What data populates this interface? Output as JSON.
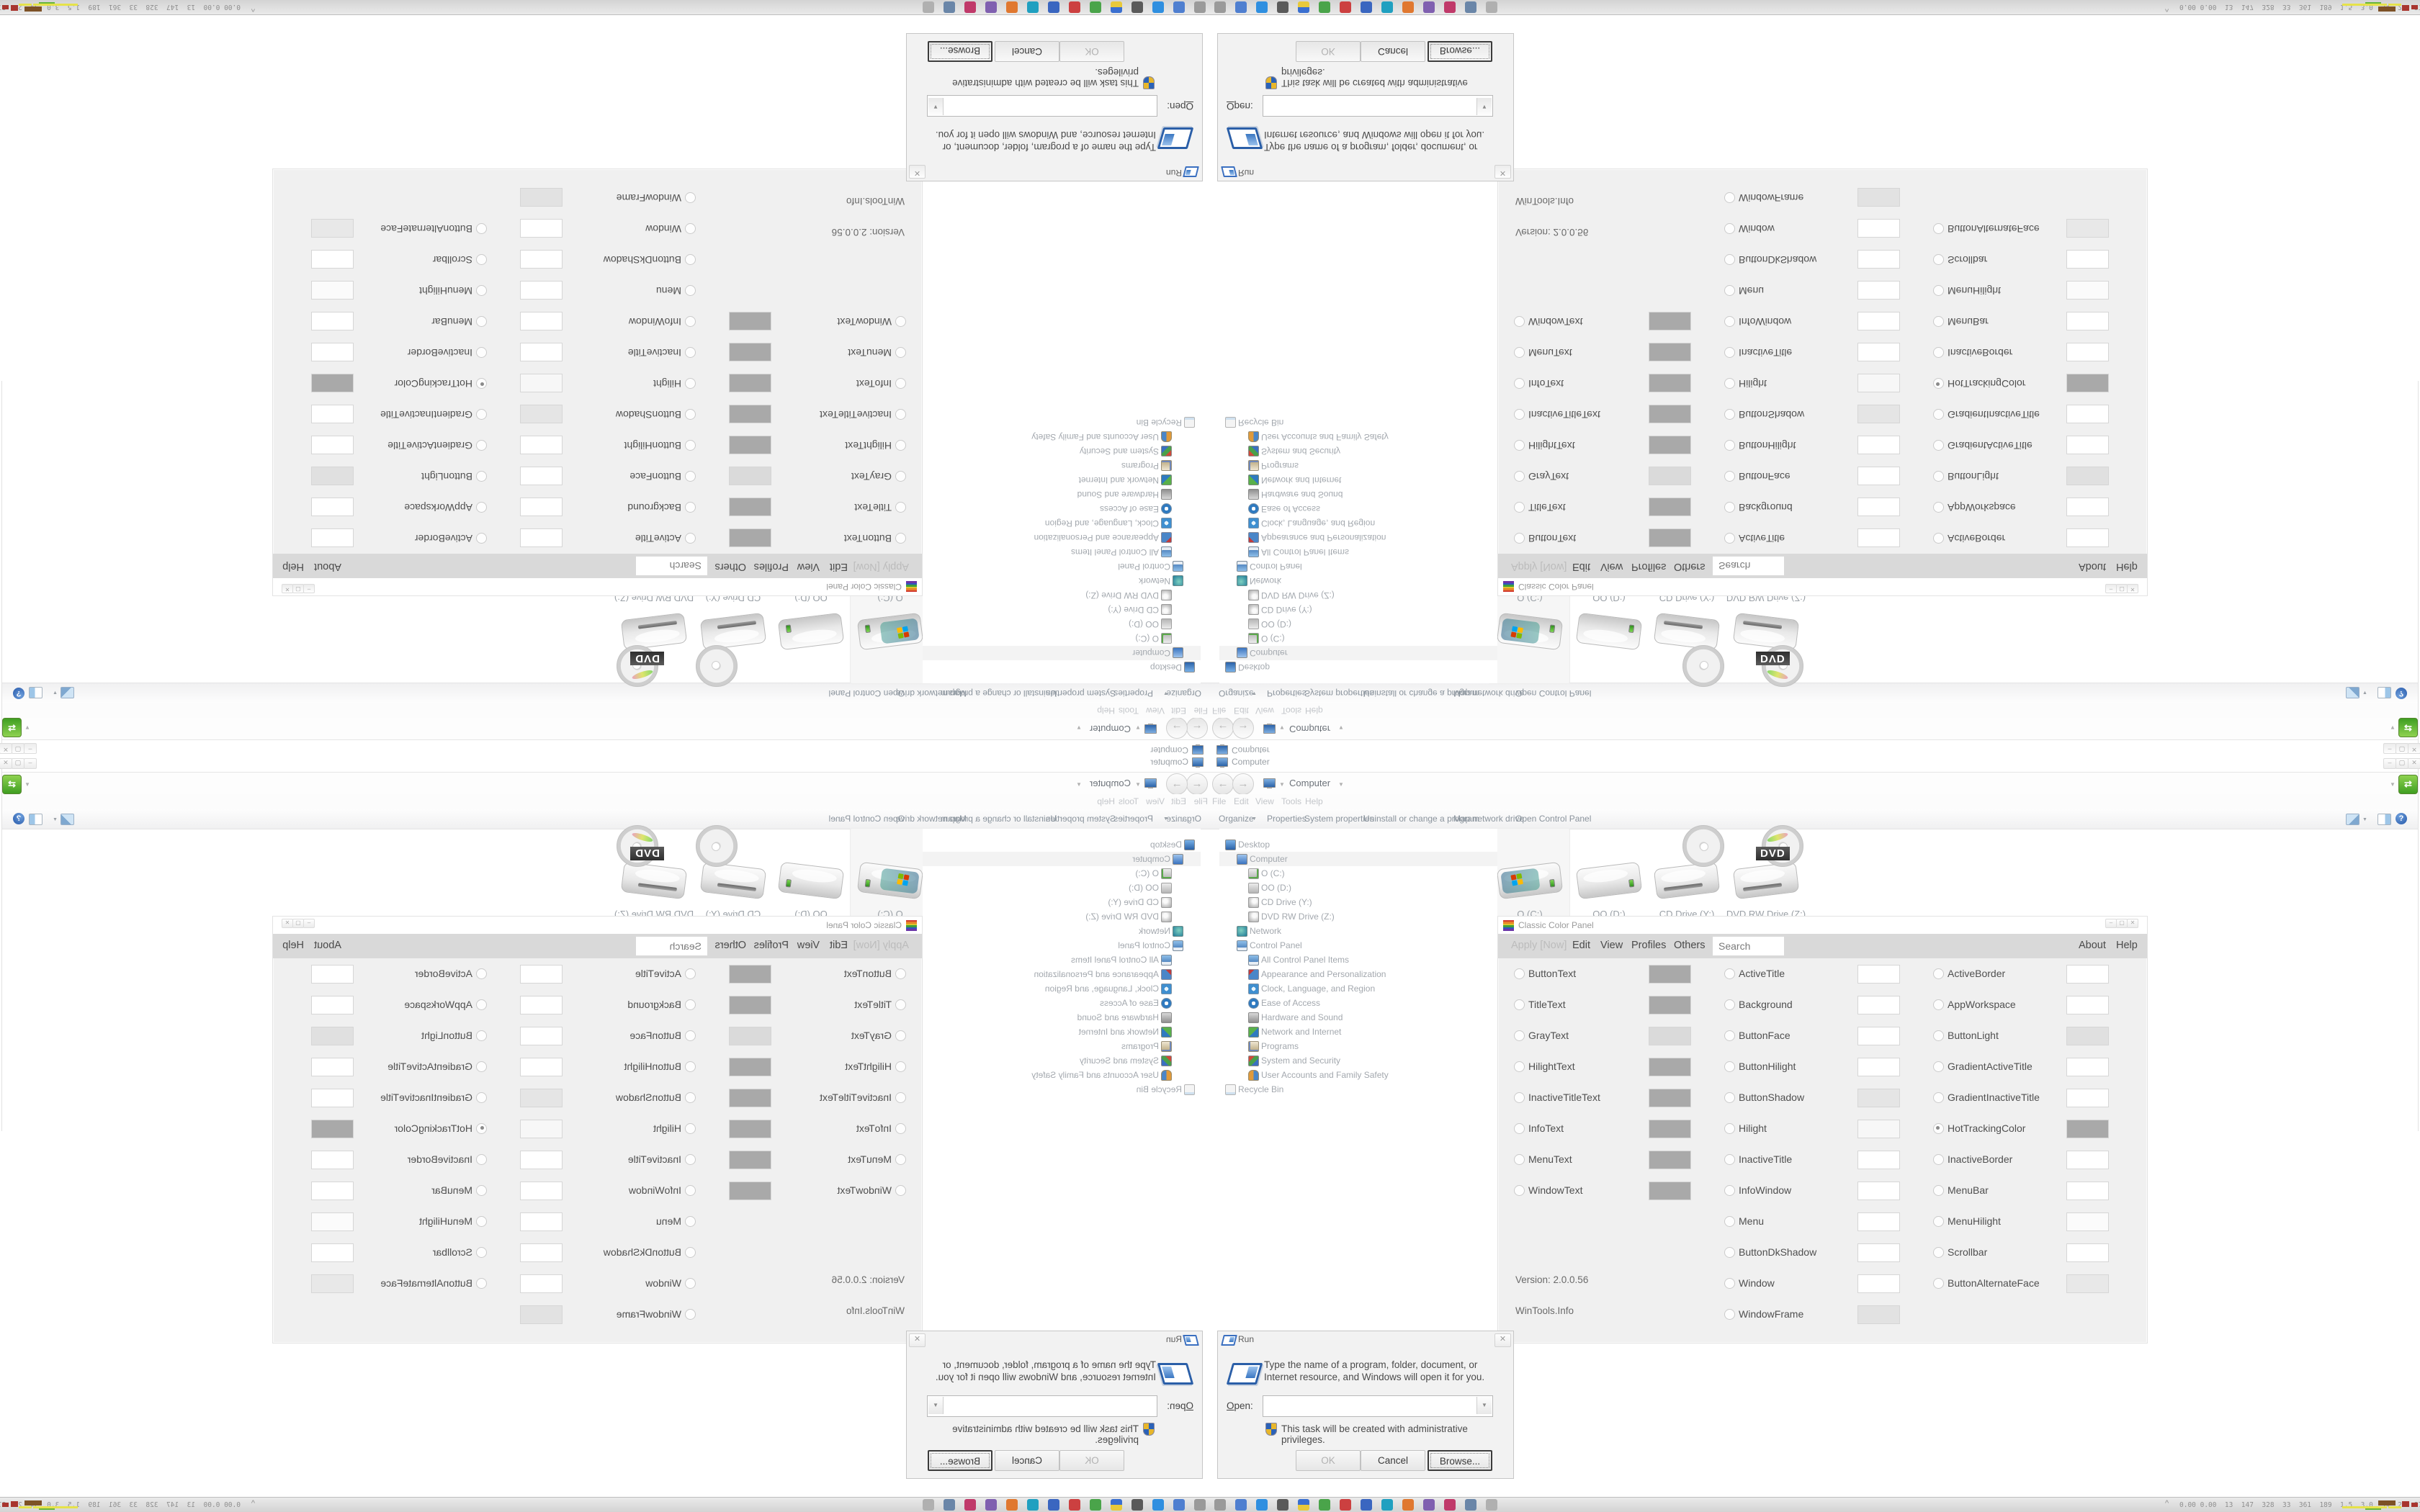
{
  "peek": {
    "computer_label": "Computer"
  },
  "explorer": {
    "menu_items": [
      "File",
      "Edit",
      "View",
      "Tools",
      "Help"
    ],
    "toolbar": {
      "organize_label": "Organize",
      "items": [
        "Properties",
        "System properties",
        "Uninstall or change a program",
        "Map network drive",
        "Open Control Panel"
      ]
    },
    "address": {
      "location": "Computer"
    },
    "dvd_tag": "DVD",
    "drives": [
      {
        "label": "O (C:)",
        "type": "system",
        "selected": true
      },
      {
        "label": "OO (D:)",
        "type": "hdd",
        "selected": false
      },
      {
        "label": "CD Drive (Y:)",
        "type": "cd",
        "selected": false
      },
      {
        "label": "DVD RW Drive (Z:)",
        "type": "dvd",
        "selected": false
      }
    ]
  },
  "tree": {
    "items": [
      {
        "label": "Desktop",
        "icon": "desktop",
        "indent": 0,
        "highlight": false
      },
      {
        "label": "Computer",
        "icon": "computer",
        "indent": 1,
        "highlight": true
      },
      {
        "label": "O (C:)",
        "icon": "system-drive",
        "indent": 2,
        "highlight": false
      },
      {
        "label": "OO (D:)",
        "icon": "hdd",
        "indent": 2,
        "highlight": false
      },
      {
        "label": "CD Drive (Y:)",
        "icon": "cd-drive",
        "indent": 2,
        "highlight": false
      },
      {
        "label": "DVD RW Drive (Z:)",
        "icon": "dvd-drive",
        "indent": 2,
        "highlight": false
      },
      {
        "label": "Network",
        "icon": "network",
        "indent": 1,
        "highlight": false
      },
      {
        "label": "Control Panel",
        "icon": "control-panel",
        "indent": 1,
        "highlight": false
      },
      {
        "label": "All Control Panel Items",
        "icon": "control-panel",
        "indent": 2,
        "highlight": false
      },
      {
        "label": "Appearance and Personalization",
        "icon": "appearance",
        "indent": 2,
        "highlight": false
      },
      {
        "label": "Clock, Language, and Region",
        "icon": "clock-region",
        "indent": 2,
        "highlight": false
      },
      {
        "label": "Ease of Access",
        "icon": "ease-access",
        "indent": 2,
        "highlight": false
      },
      {
        "label": "Hardware and Sound",
        "icon": "hardware",
        "indent": 2,
        "highlight": false
      },
      {
        "label": "Network and Internet",
        "icon": "net-internet",
        "indent": 2,
        "highlight": false
      },
      {
        "label": "Programs",
        "icon": "programs",
        "indent": 2,
        "highlight": false
      },
      {
        "label": "System and Security",
        "icon": "sys-security",
        "indent": 2,
        "highlight": false
      },
      {
        "label": "User Accounts and Family Safety",
        "icon": "users",
        "indent": 2,
        "highlight": false
      },
      {
        "label": "Recycle Bin",
        "icon": "recycle",
        "indent": 0,
        "highlight": false
      }
    ]
  },
  "ccp": {
    "title": "Classic Color Panel",
    "menu": {
      "apply_label": "Apply [Now]",
      "items": [
        "Edit",
        "View",
        "Profiles",
        "Others"
      ],
      "search_placeholder": "Search",
      "right_items": [
        "About",
        "Help"
      ]
    },
    "version": "Version: 2.0.0.56",
    "vendor": "WinTools.Info",
    "columns": [
      [
        {
          "name": "ButtonText",
          "swatch": "#a9a9a9",
          "selected": false
        },
        {
          "name": "TitleText",
          "swatch": "#a9a9a9",
          "selected": false
        },
        {
          "name": "GrayText",
          "swatch": "#dadada",
          "selected": false
        },
        {
          "name": "HilightText",
          "swatch": "#a9a9a9",
          "selected": false
        },
        {
          "name": "InactiveTitleText",
          "swatch": "#a9a9a9",
          "selected": false
        },
        {
          "name": "InfoText",
          "swatch": "#a9a9a9",
          "selected": false
        },
        {
          "name": "MenuText",
          "swatch": "#a9a9a9",
          "selected": false
        },
        {
          "name": "WindowText",
          "swatch": "#a9a9a9",
          "selected": false
        }
      ],
      [
        {
          "name": "ActiveTitle",
          "swatch": "#ffffff",
          "selected": false
        },
        {
          "name": "Background",
          "swatch": "#ffffff",
          "selected": false
        },
        {
          "name": "ButtonFace",
          "swatch": "#ffffff",
          "selected": false
        },
        {
          "name": "ButtonHilight",
          "swatch": "#ffffff",
          "selected": false
        },
        {
          "name": "ButtonShadow",
          "swatch": "#e5e5e5",
          "selected": false
        },
        {
          "name": "Hilight",
          "swatch": "#f7f7f7",
          "selected": false
        },
        {
          "name": "InactiveTitle",
          "swatch": "#ffffff",
          "selected": false
        },
        {
          "name": "InfoWindow",
          "swatch": "#ffffff",
          "selected": false
        },
        {
          "name": "Menu",
          "swatch": "#ffffff",
          "selected": false
        },
        {
          "name": "ButtonDkShadow",
          "swatch": "#ffffff",
          "selected": false
        },
        {
          "name": "Window",
          "swatch": "#ffffff",
          "selected": false
        },
        {
          "name": "WindowFrame",
          "swatch": "#e2e2e2",
          "selected": false
        }
      ],
      [
        {
          "name": "ActiveBorder",
          "swatch": "#ffffff",
          "selected": false
        },
        {
          "name": "AppWorkspace",
          "swatch": "#ffffff",
          "selected": false
        },
        {
          "name": "ButtonLight",
          "swatch": "#e0e0e0",
          "selected": false
        },
        {
          "name": "GradientActiveTitle",
          "swatch": "#ffffff",
          "selected": false
        },
        {
          "name": "GradientInactiveTitle",
          "swatch": "#ffffff",
          "selected": false
        },
        {
          "name": "HotTrackingColor",
          "swatch": "#a9a9a9",
          "selected": true
        },
        {
          "name": "InactiveBorder",
          "swatch": "#ffffff",
          "selected": false
        },
        {
          "name": "MenuBar",
          "swatch": "#ffffff",
          "selected": false
        },
        {
          "name": "MenuHilight",
          "swatch": "#fbfbfb",
          "selected": false
        },
        {
          "name": "Scrollbar",
          "swatch": "#ffffff",
          "selected": false
        },
        {
          "name": "ButtonAlternateFace",
          "swatch": "#e8e8e8",
          "selected": false
        }
      ]
    ]
  },
  "run": {
    "title": "Run",
    "description": "Type the name of a program, folder, document, or Internet resource, and Windows will open it for you.",
    "open_label": "Open:",
    "open_value": "",
    "admin_note": "This task will be created with administrative privileges.",
    "ok_label": "OK",
    "cancel_label": "Cancel",
    "browse_label": "Browse..."
  },
  "taskbar": {
    "chevron": "^",
    "stats": "0.00 0.00  13  147  328  33  361  189  1.5  3.0  34  29  2758 3839",
    "icon_colors": [
      "#9a9a9a",
      "#4f7fd0",
      "#2f8fe0",
      "#5a5a5a",
      "flag",
      "#4aa44a",
      "#cc4040",
      "#3a66c0",
      "#20a0c0",
      "#e07830",
      "#8060b0",
      "#c03a6a",
      "#6a86a8",
      "#b0b0b0"
    ],
    "graph_colors": {
      "yellow": "#e6e24a",
      "green": "#66b53a",
      "brown": "#7d5126",
      "red": "#a8352f"
    }
  }
}
